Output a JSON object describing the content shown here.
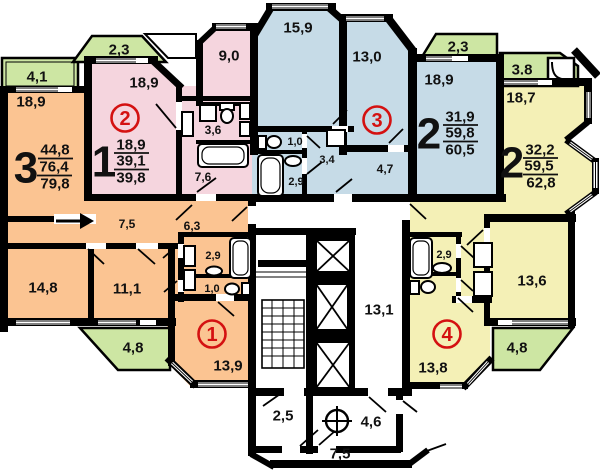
{
  "palette": {
    "orange": "#fbc492",
    "pink": "#f5d5de",
    "blue": "#c6dbe7",
    "yellow": "#f4f0b6",
    "green": "#cde6a3",
    "wall": "#000000",
    "accent_red": "#d41111"
  },
  "plan": {
    "balconies": {
      "b41": "4,1",
      "b23_left": "2,3",
      "b23_right": "2,3",
      "b38": "3.8",
      "b48_left": "4,8",
      "b48_right": "4,8"
    },
    "apt_orange": {
      "rooms_label": "3",
      "area_living": "44,8",
      "area_total": "76,4",
      "area_full": "79,8",
      "flat_no": "1",
      "r_189": "18,9",
      "r_75": "7,5",
      "r_63": "6,3",
      "r_148": "14,8",
      "r_111": "11,1",
      "r_29": "2,9",
      "r_10": "1,0",
      "r_139": "13,9"
    },
    "apt_pink": {
      "rooms_label": "1",
      "area_living": "18,9",
      "area_total": "39,1",
      "area_full": "39,8",
      "flat_no": "2",
      "r_189": "18,9",
      "r_90": "9,0",
      "r_36": "3,6",
      "r_76": "7,6"
    },
    "apt_blue": {
      "rooms_label": "2",
      "area_living": "31,9",
      "area_total": "59,8",
      "area_full": "60,5",
      "flat_no": "3",
      "r_159": "15,9",
      "r_130": "13,0",
      "r_189": "18,9",
      "r_10": "1,0",
      "r_34": "3,4",
      "r_29": "2,9",
      "r_47": "4,7"
    },
    "apt_yellow": {
      "rooms_label": "2",
      "area_living": "32,2",
      "area_total": "59,5",
      "area_full": "62,8",
      "flat_no": "4",
      "r_187": "18,7",
      "r_29": "2,9",
      "r_136": "13,6",
      "r_138": "13,8"
    },
    "common": {
      "r_131": "13,1",
      "r_25": "2,5",
      "r_46": "4,6",
      "r_75": "7,5"
    }
  }
}
